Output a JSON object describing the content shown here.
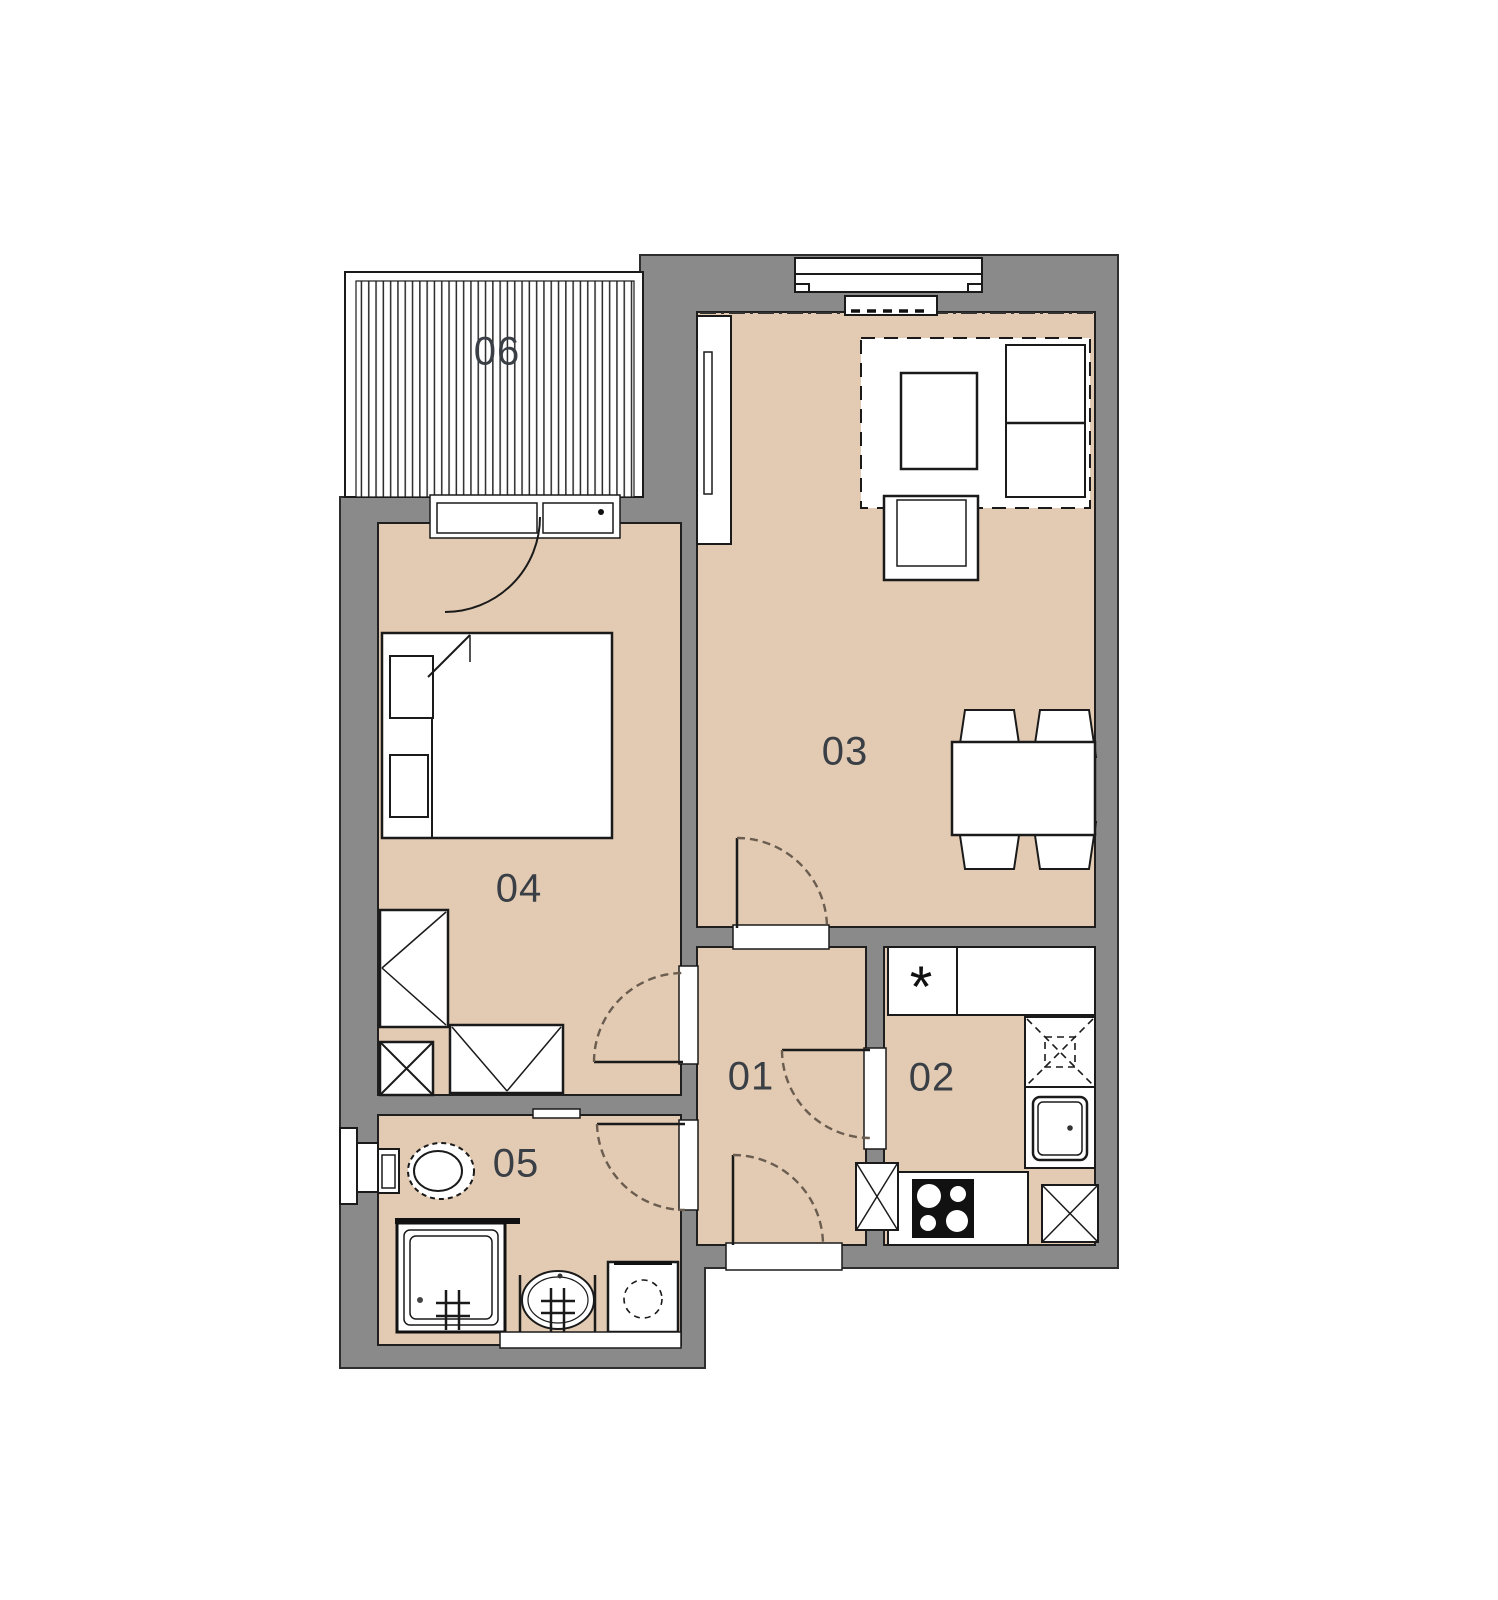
{
  "page": {
    "type": "apartment-floor-plan",
    "background": "#ffffff"
  },
  "colors": {
    "floor": "#e3cbb3",
    "wall": "#8a8a8a",
    "outline": "#2e2e2e",
    "label": "#3a3f46",
    "door_arc": "#6a5d50",
    "furniture_fill": "#ffffff",
    "line": "#1a1a1a"
  },
  "rooms": [
    {
      "label": "01"
    },
    {
      "label": "02"
    },
    {
      "label": "03"
    },
    {
      "label": "04"
    },
    {
      "label": "05"
    },
    {
      "label": "06"
    }
  ],
  "kitchen_counter_symbol": "*",
  "fixtures": [
    "balcony-decking-hatch",
    "balcony-door",
    "window-with-radiator",
    "tv-sideboard",
    "tv",
    "corner-sofa-with-rug",
    "coffee-table",
    "armchair",
    "dining-table",
    "dining-chairs-x4",
    "kitchen-counter",
    "kitchen-hood-dashed",
    "kitchen-sink",
    "stove-4-burners",
    "ventilation-shaft-x2",
    "double-bed",
    "pillows-x2",
    "wardrobe-tall",
    "wardrobe-low",
    "corner-shaft",
    "toilet",
    "toilet-cistern",
    "shower-cabin",
    "washbasin",
    "washing-machine",
    "interior-doors-x5",
    "entrance-door"
  ]
}
